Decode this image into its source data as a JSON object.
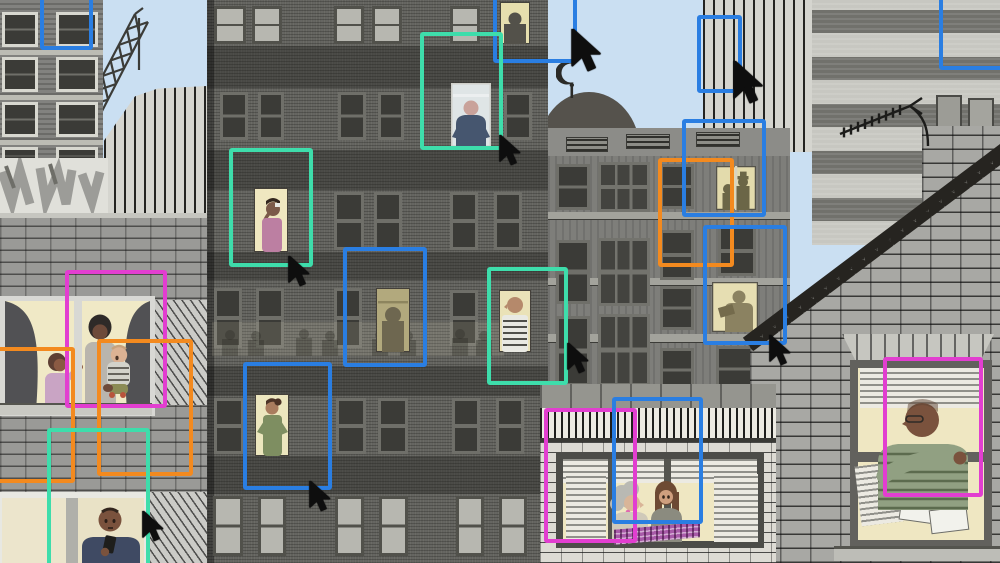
{
  "scene": {
    "description": "Collage-style illustration of city apartment buildings at dusk; residents in lit windows are overlaid with colored surveillance bounding boxes and black mouse cursors",
    "text_content": "none"
  },
  "palette": {
    "sky": "#cadff2",
    "box_blue": "#2a7ee2",
    "box_teal": "#3eddab",
    "box_magenta": "#e23ed0",
    "box_orange": "#f38a1f",
    "cursor": "#0e0e0e",
    "window_glow": "#efe7c2"
  },
  "annotations": {
    "boxes": [
      {
        "id": "box-blue-topleft",
        "color": "box_blue",
        "x": 40,
        "y": -10,
        "w": 53,
        "h": 60
      },
      {
        "id": "box-blue-top-center",
        "color": "box_blue",
        "x": 493,
        "y": -10,
        "w": 84,
        "h": 73
      },
      {
        "id": "box-blue-sky-right",
        "color": "box_blue",
        "x": 697,
        "y": 15,
        "w": 45,
        "h": 78
      },
      {
        "id": "box-blue-topright",
        "color": "box_blue",
        "x": 939,
        "y": -10,
        "w": 72,
        "h": 80
      },
      {
        "id": "box-teal-navy-man",
        "color": "box_teal",
        "x": 420,
        "y": 32,
        "w": 83,
        "h": 118
      },
      {
        "id": "box-teal-drinking-woman",
        "color": "box_teal",
        "x": 229,
        "y": 148,
        "w": 84,
        "h": 119
      },
      {
        "id": "box-blue-dim-window",
        "color": "box_blue",
        "x": 343,
        "y": 247,
        "w": 84,
        "h": 120
      },
      {
        "id": "box-teal-striped-man",
        "color": "box_teal",
        "x": 487,
        "y": 267,
        "w": 81,
        "h": 118
      },
      {
        "id": "box-blue-green-woman",
        "color": "box_blue",
        "x": 243,
        "y": 362,
        "w": 89,
        "h": 128
      },
      {
        "id": "box-magenta-mother-baby",
        "color": "box_magenta",
        "x": 65,
        "y": 270,
        "w": 102,
        "h": 138
      },
      {
        "id": "box-orange-left-cropped",
        "color": "box_orange",
        "x": -16,
        "y": 347,
        "w": 91,
        "h": 136
      },
      {
        "id": "box-orange-family",
        "color": "box_orange",
        "x": 97,
        "y": 339,
        "w": 96,
        "h": 137
      },
      {
        "id": "box-teal-phone-man",
        "color": "box_teal",
        "x": 47,
        "y": 428,
        "w": 103,
        "h": 150
      },
      {
        "id": "box-orange-duo-window",
        "color": "box_orange",
        "x": 658,
        "y": 158,
        "w": 76,
        "h": 109
      },
      {
        "id": "box-blue-concrete-upper",
        "color": "box_blue",
        "x": 682,
        "y": 119,
        "w": 84,
        "h": 98
      },
      {
        "id": "box-blue-reading-window",
        "color": "box_blue",
        "x": 703,
        "y": 225,
        "w": 84,
        "h": 120
      },
      {
        "id": "box-magenta-lounge",
        "color": "box_magenta",
        "x": 544,
        "y": 408,
        "w": 93,
        "h": 135
      },
      {
        "id": "box-blue-lounge",
        "color": "box_blue",
        "x": 612,
        "y": 397,
        "w": 91,
        "h": 127
      },
      {
        "id": "box-magenta-old-man",
        "color": "box_magenta",
        "x": 883,
        "y": 357,
        "w": 100,
        "h": 140
      }
    ],
    "cursors": [
      {
        "id": "cursor-phone-man",
        "x": 142,
        "y": 511,
        "scale": 1
      },
      {
        "id": "cursor-drinking-woman",
        "x": 288,
        "y": 256,
        "scale": 1
      },
      {
        "id": "cursor-green-woman",
        "x": 309,
        "y": 481,
        "scale": 1
      },
      {
        "id": "cursor-navy-man",
        "x": 499,
        "y": 135,
        "scale": 1
      },
      {
        "id": "cursor-sky-center",
        "x": 571,
        "y": 29,
        "scale": 1.4
      },
      {
        "id": "cursor-sky-right",
        "x": 733,
        "y": 61,
        "scale": 1.4
      },
      {
        "id": "cursor-striped-man",
        "x": 567,
        "y": 343,
        "scale": 1
      },
      {
        "id": "cursor-reading-window",
        "x": 769,
        "y": 335,
        "scale": 1
      }
    ]
  },
  "figures": [
    {
      "label": "silhouette in rooftop window"
    },
    {
      "label": "man in navy jumper seen from behind"
    },
    {
      "label": "woman sipping a drink"
    },
    {
      "label": "faint silhouette in dim window"
    },
    {
      "label": "bald man in striped shirt"
    },
    {
      "label": "woman in green with hair bun"
    },
    {
      "label": "two silhouettes, one wearing a hat"
    },
    {
      "label": "person reading by lamplight"
    },
    {
      "label": "girl, mother and baby at living-room window"
    },
    {
      "label": "man looking at his phone"
    },
    {
      "label": "two women chatting at a wide window"
    },
    {
      "label": "older man in striped green jumper"
    }
  ]
}
